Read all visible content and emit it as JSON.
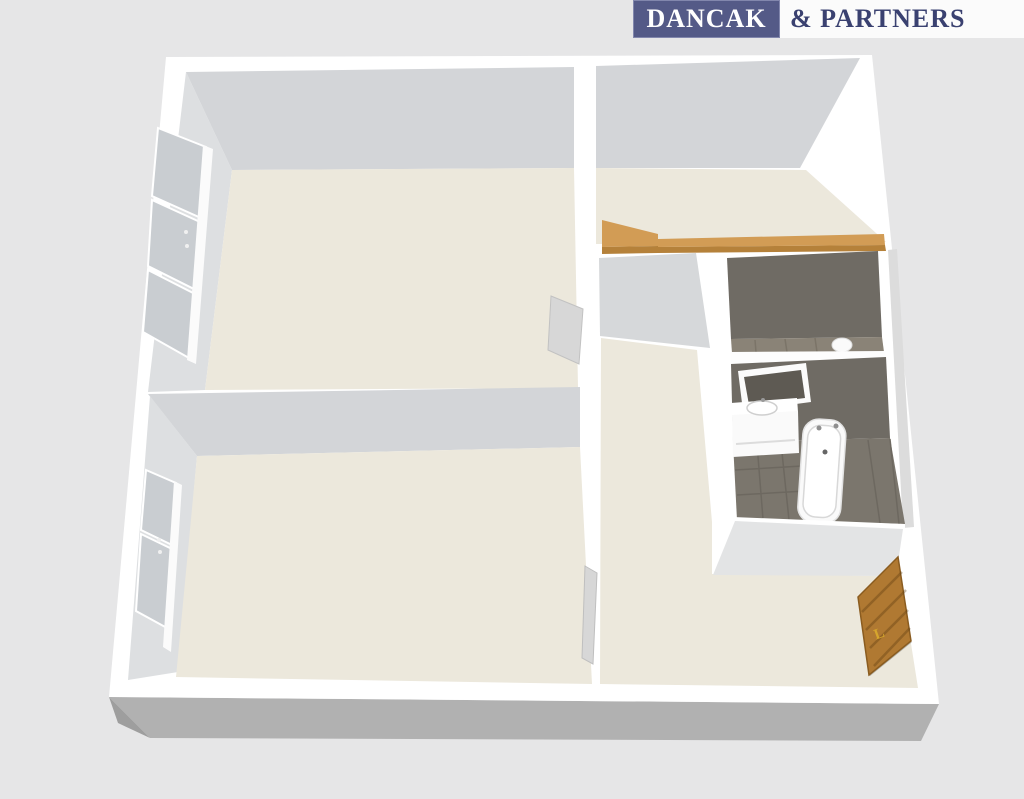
{
  "logo": {
    "primary": "DANCAK",
    "secondary": "& PARTNERS"
  },
  "entrance_door": {
    "handle_label": "L"
  },
  "floorplan": {
    "kind": "3d-apartment-floor-plan-render"
  },
  "colors": {
    "background": "#e6e6e7",
    "wall_white": "#ffffff",
    "wall_face_gray": "#d3d5d8",
    "wall_face_light": "#dddfe1",
    "floor_beige": "#ece8dc",
    "exterior_shadow": "#b1b1b1",
    "exterior_shadow_dark": "#9e9e9e",
    "window_glass": "#c9cdd1",
    "window_frame": "#fbfbfb",
    "door_leaf_gray": "#d7d7d7",
    "tile_dark_wall": "#6f6b64",
    "tile_dark_floor": "#7b766d",
    "wc_floor": "#8a8377",
    "counter_wood_top": "#d29c55",
    "counter_wood_front": "#b5813a",
    "door_wood": "#b07932",
    "door_handle_gold": "#d6a52d",
    "fixture_white": "#fafafa",
    "mirror_glass": "#5e5a53",
    "divider_white": "#fdfdfd",
    "block_south_face": "#e3e4e5",
    "hall_gray_face": "#d6d8da",
    "right_wall_shade": "#dcdcdc",
    "logo_bg": "#545a87",
    "logo_text_light": "#ffffff",
    "logo_text_dark": "#3a4170"
  }
}
